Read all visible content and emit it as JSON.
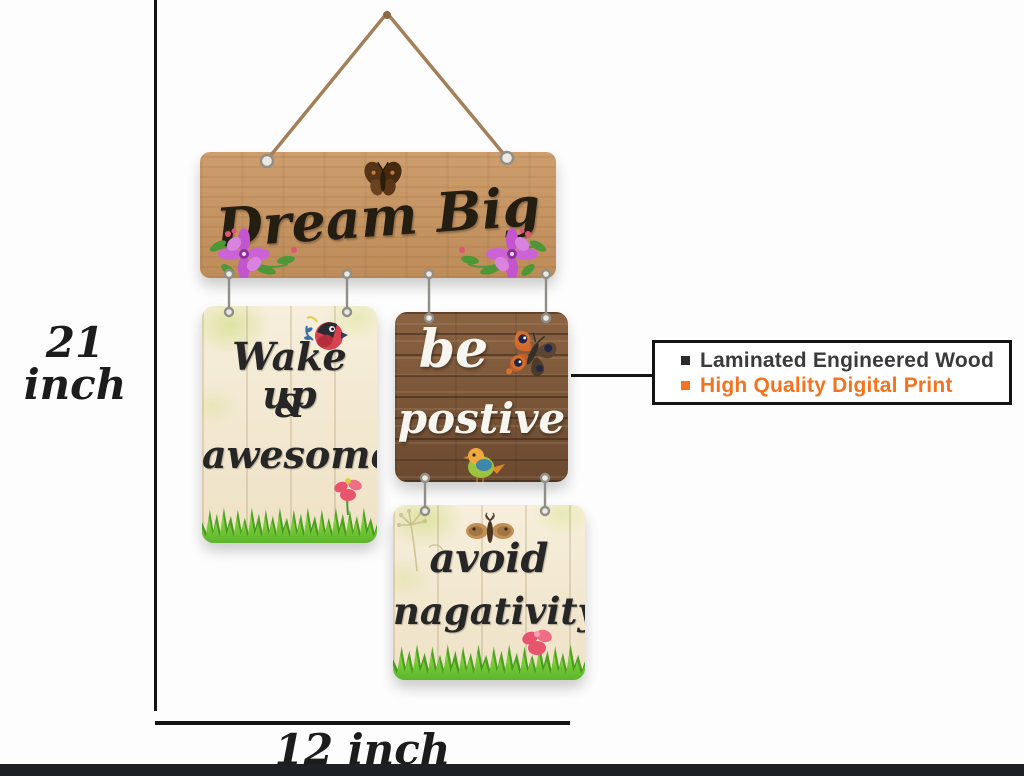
{
  "product": {
    "boards": {
      "top": {
        "text": "Dream Big"
      },
      "left": {
        "lines": [
          "Wake up",
          "&",
          "awesome"
        ]
      },
      "middle": {
        "lines": [
          "be",
          "postive"
        ]
      },
      "bottom": {
        "lines": [
          "avoid",
          "nagativity"
        ]
      }
    }
  },
  "dimensions": {
    "height_label": "21 inch",
    "width_label": "12 inch"
  },
  "callout": {
    "items": [
      {
        "label": "Laminated Engineered Wood",
        "color": "#3b3b3b"
      },
      {
        "label": "High Quality Digital Print",
        "color": "#f4731f"
      }
    ]
  },
  "decor": {
    "icons": [
      "rope-hanger-icon",
      "butterfly-icon",
      "orange-butterfly-icon",
      "moth-icon",
      "flower-icon",
      "red-bird-icon",
      "colorful-bird-icon",
      "grass-icon",
      "dandelion-icon",
      "connector-hook-icon"
    ]
  },
  "colors": {
    "accent_orange": "#f4731f",
    "annotation_black": "#141414",
    "wood_light": "#c79a6a",
    "wood_dark": "#7a5535",
    "board_cream": "#f4ecd9",
    "grass_green": "#6cc232",
    "flower_pink": "#c355cf",
    "bottom_bar": "#1d2025"
  }
}
